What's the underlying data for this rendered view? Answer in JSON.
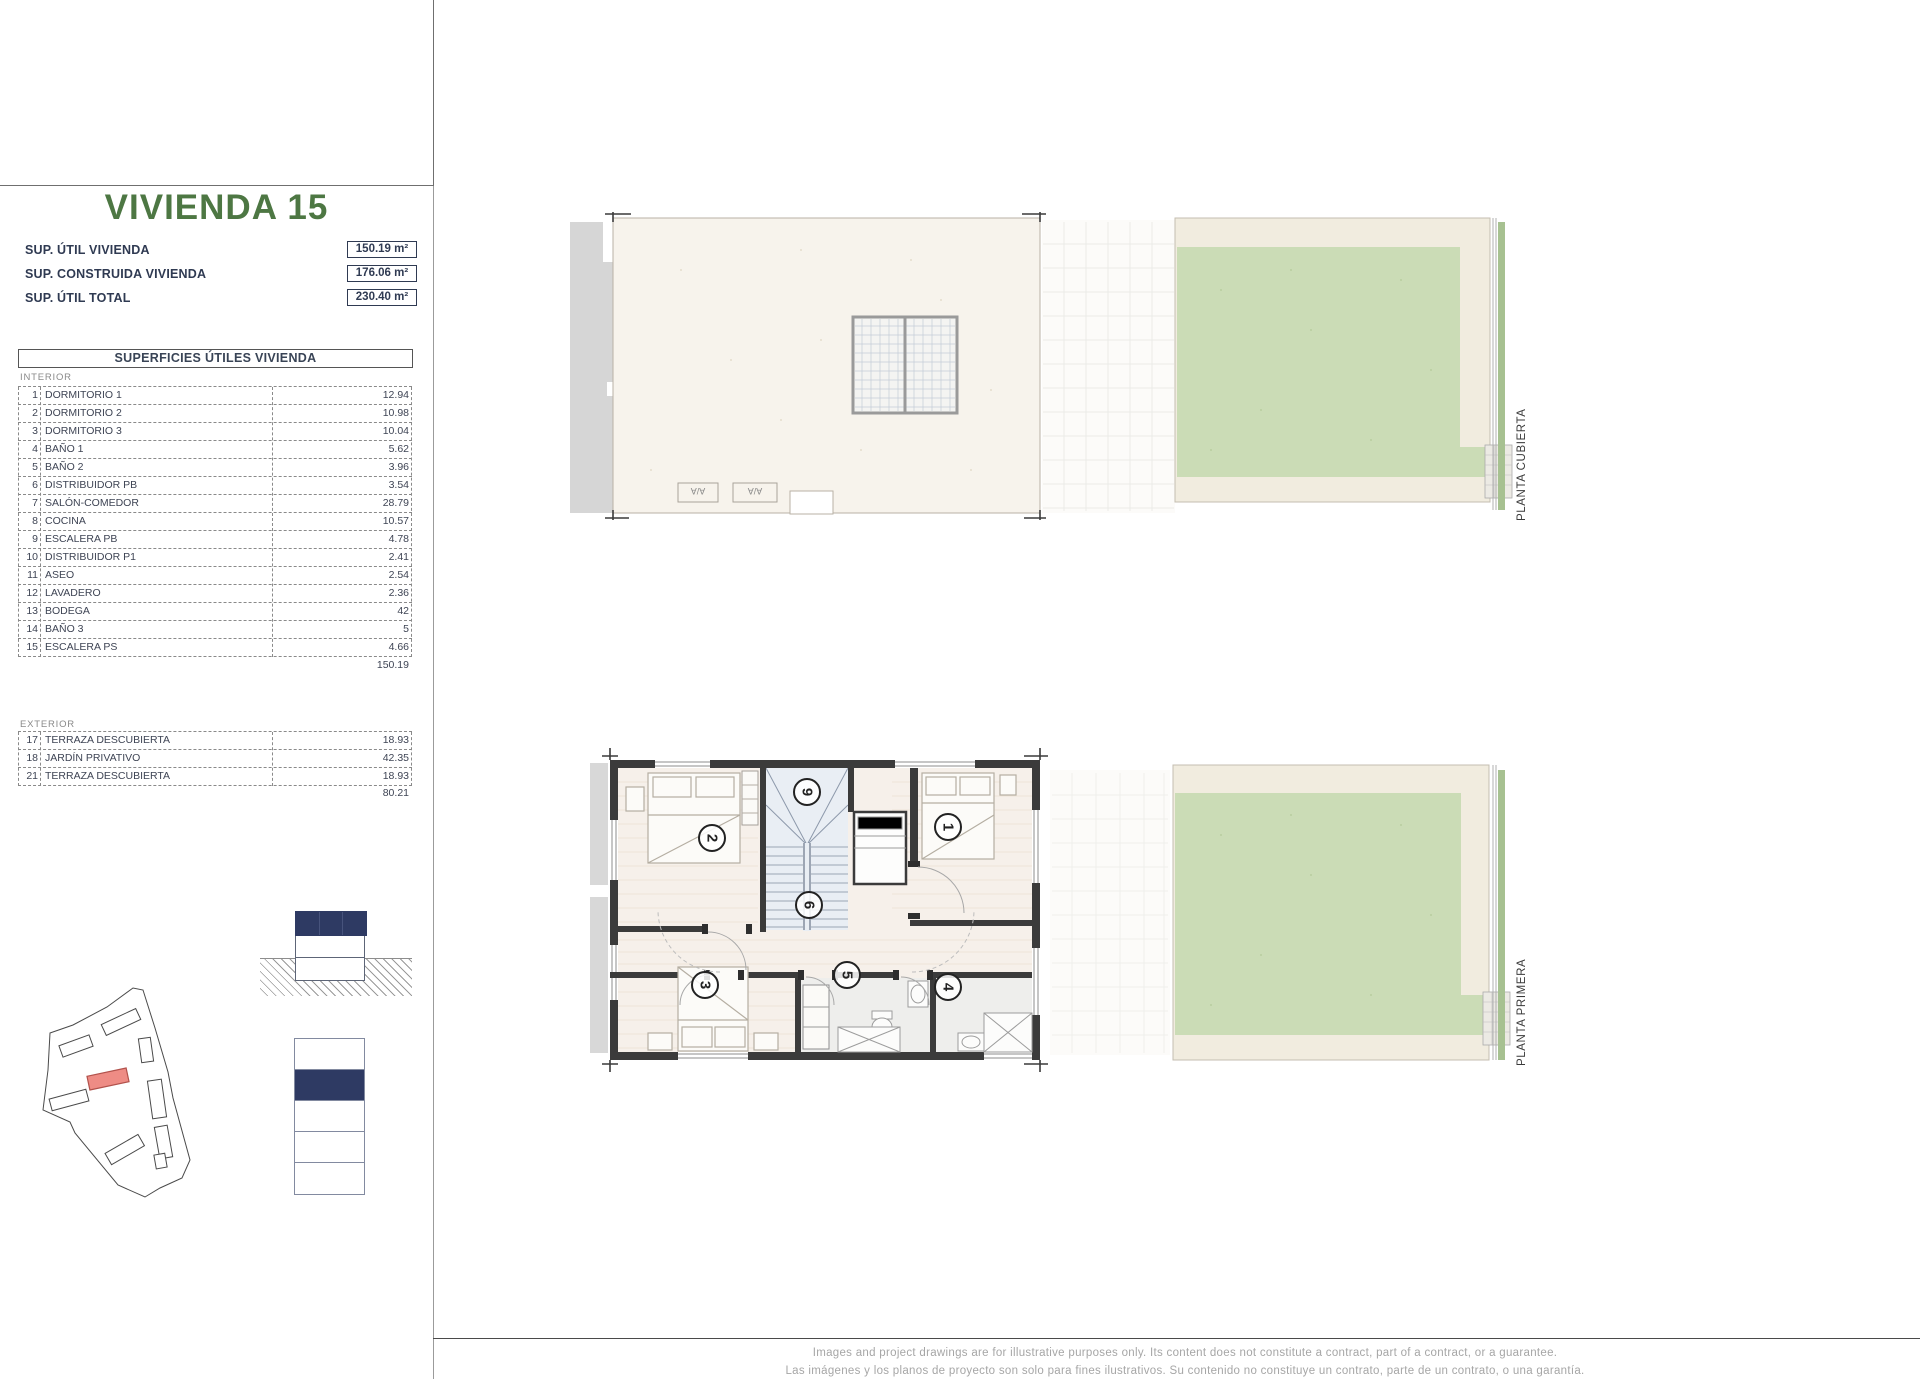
{
  "header": {
    "title": "VIVIENDA 15",
    "summary": [
      {
        "label": "SUP. ÚTIL VIVIENDA",
        "value": "150.19 m²"
      },
      {
        "label": "SUP. CONSTRUIDA VIVIENDA",
        "value": "176.06 m²"
      },
      {
        "label": "SUP. ÚTIL TOTAL",
        "value": "230.40 m²"
      }
    ]
  },
  "table": {
    "title": "SUPERFICIES ÚTILES VIVIENDA",
    "interior_label": "INTERIOR",
    "interior_rows": [
      {
        "num": "1",
        "name": "DORMITORIO 1",
        "value": "12.94"
      },
      {
        "num": "2",
        "name": "DORMITORIO 2",
        "value": "10.98"
      },
      {
        "num": "3",
        "name": "DORMITORIO 3",
        "value": "10.04"
      },
      {
        "num": "4",
        "name": "BAÑO 1",
        "value": "5.62"
      },
      {
        "num": "5",
        "name": "BAÑO 2",
        "value": "3.96"
      },
      {
        "num": "6",
        "name": "DISTRIBUIDOR PB",
        "value": "3.54"
      },
      {
        "num": "7",
        "name": "SALÓN-COMEDOR",
        "value": "28.79"
      },
      {
        "num": "8",
        "name": "COCINA",
        "value": "10.57"
      },
      {
        "num": "9",
        "name": "ESCALERA PB",
        "value": "4.78"
      },
      {
        "num": "10",
        "name": "DISTRIBUIDOR P1",
        "value": "2.41"
      },
      {
        "num": "11",
        "name": "ASEO",
        "value": "2.54"
      },
      {
        "num": "12",
        "name": "LAVADERO",
        "value": "2.36"
      },
      {
        "num": "13",
        "name": "BODEGA",
        "value": "42"
      },
      {
        "num": "14",
        "name": "BAÑO 3",
        "value": "5"
      },
      {
        "num": "15",
        "name": "ESCALERA PS",
        "value": "4.66"
      }
    ],
    "interior_total": "150.19",
    "exterior_label": "EXTERIOR",
    "exterior_rows": [
      {
        "num": "17",
        "name": "TERRAZA DESCUBIERTA",
        "value": "18.93"
      },
      {
        "num": "18",
        "name": "JARDÍN PRIVATIVO",
        "value": "42.35"
      },
      {
        "num": "21",
        "name": "TERRAZA DESCUBIERTA",
        "value": "18.93"
      }
    ],
    "exterior_total": "80.21"
  },
  "plans": {
    "top_label": "PLANTA CUBIERTA",
    "bottom_label": "PLANTA PRIMERA",
    "ac_label": "A/A",
    "rooms": {
      "r1": "1",
      "r2": "2",
      "r3": "3",
      "r4": "4",
      "r5": "5",
      "r6": "6",
      "r9": "9"
    }
  },
  "footer": {
    "line1": "Images and project drawings are for illustrative purposes only. Its content does not constitute a contract, part of a contract, or a guarantee.",
    "line2": "Las imágenes y los planos de proyecto son solo para fines ilustrativos. Su contenido no constituye un contrato, parte de un contrato, o una garantía."
  },
  "colors": {
    "title_green": "#4d7743",
    "navy": "#2e3a63",
    "garden_green": "#cbdcb6",
    "garden_strip_green": "#a7c191",
    "terrace_beige": "#f1ecdf",
    "roof_cream": "#f7f3ec",
    "wall_dark": "#3b3b3b",
    "highlight_red": "#ee8c85"
  }
}
